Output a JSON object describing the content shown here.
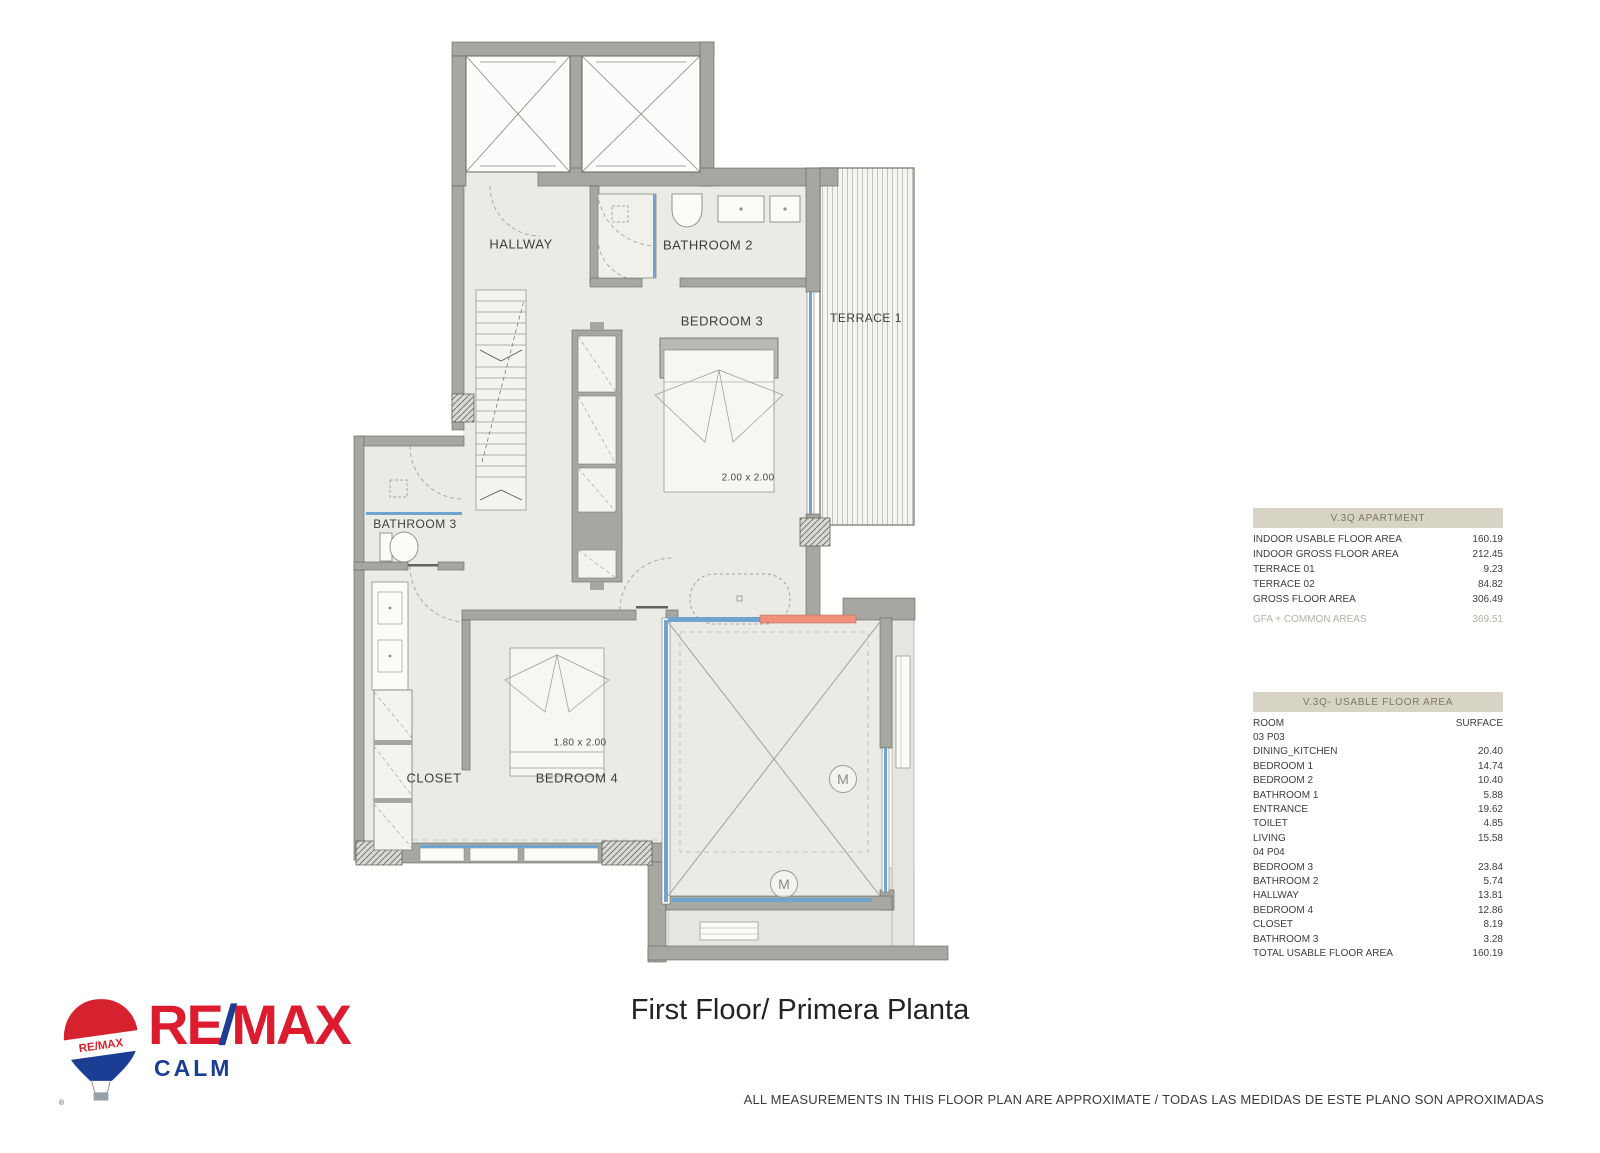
{
  "plan": {
    "labels": {
      "hallway": "HALLWAY",
      "bathroom2": "BATHROOM 2",
      "bedroom3": "BEDROOM 3",
      "terrace1": "TERRACE 1",
      "bathroom3": "BATHROOM 3",
      "closet": "CLOSET",
      "bedroom4": "BEDROOM 4",
      "bed3_dim": "2.00 x 2.00",
      "bed4_dim": "1.80 x 2.00",
      "mirror_marker": "M"
    }
  },
  "apartment_table": {
    "title": "V.3Q APARTMENT",
    "rows": [
      {
        "label": "INDOOR USABLE FLOOR AREA",
        "value": "160.19"
      },
      {
        "label": "INDOOR GROSS FLOOR AREA",
        "value": "212.45"
      },
      {
        "label": "TERRACE 01",
        "value": "9.23"
      },
      {
        "label": "TERRACE 02",
        "value": "84.82"
      },
      {
        "label": "GROSS FLOOR AREA",
        "value": "306.49"
      }
    ],
    "footer": {
      "label": "GFA + COMMON AREAS",
      "value": "369.51"
    }
  },
  "usable_table": {
    "title": "V.3Q- USABLE FLOOR AREA",
    "col_room": "ROOM",
    "col_surface": "SURFACE",
    "rows": [
      {
        "label": "03 P03",
        "value": ""
      },
      {
        "label": "DINING_KITCHEN",
        "value": "20.40"
      },
      {
        "label": "BEDROOM 1",
        "value": "14.74"
      },
      {
        "label": "BEDROOM 2",
        "value": "10.40"
      },
      {
        "label": "BATHROOM 1",
        "value": "5.88"
      },
      {
        "label": "ENTRANCE",
        "value": "19.62"
      },
      {
        "label": "TOILET",
        "value": "4.85"
      },
      {
        "label": "LIVING",
        "value": "15.58"
      },
      {
        "label": "04 P04",
        "value": ""
      },
      {
        "label": "BEDROOM 3",
        "value": "23.84"
      },
      {
        "label": "BATHROOM 2",
        "value": "5.74"
      },
      {
        "label": "HALLWAY",
        "value": "13.81"
      },
      {
        "label": "BEDROOM 4",
        "value": "12.86"
      },
      {
        "label": "CLOSET",
        "value": "8.19"
      },
      {
        "label": "BATHROOM 3",
        "value": "3.28"
      },
      {
        "label": "TOTAL USABLE FLOOR AREA",
        "value": "160.19"
      }
    ]
  },
  "footer": {
    "title": "First Floor/ Primera Planta",
    "disclaimer": "ALL MEASUREMENTS IN THIS FLOOR PLAN ARE APPROXIMATE / TODAS LAS MEDIDAS DE ESTE PLANO SON APROXIMADAS"
  },
  "logo": {
    "brand_re": "RE",
    "brand_slash": "/",
    "brand_max": "MAX",
    "office": "CALM",
    "balloon_text": "RE/MAX",
    "registered": "®"
  },
  "colors": {
    "remax_red": "#dc1c2e",
    "remax_blue": "#1b3e94",
    "wall_gray": "#a7a7a2",
    "room_fill": "#ebebe6",
    "window_blue": "#6fa3d0",
    "accent_red": "#f2907e",
    "table_header_bg": "#d7d3c5"
  }
}
